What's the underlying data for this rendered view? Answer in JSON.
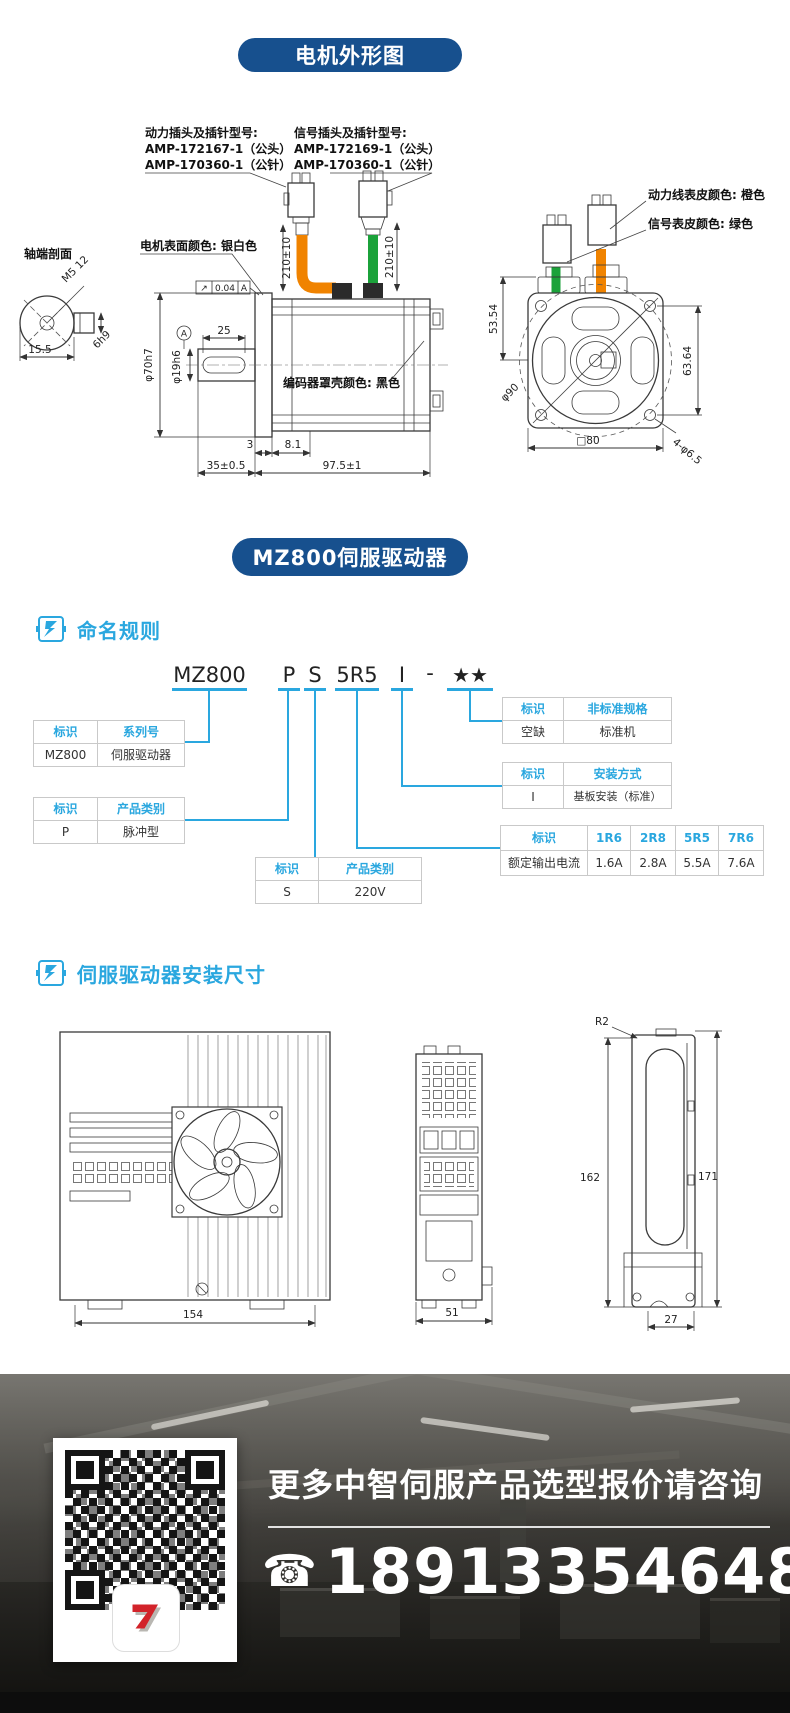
{
  "badges": {
    "motor": "电机外形图",
    "driver": "MZ800伺服驱动器"
  },
  "colors": {
    "accent": "#2AA7DF",
    "badge_bg": "#17508E",
    "power_cable": "#F08300",
    "signal_cable": "#1BA23A"
  },
  "motor": {
    "labels": {
      "power_plug": [
        "动力插头及插针型号:",
        "AMP-172167-1（公头）",
        "AMP-170360-1（公针）"
      ],
      "signal_plug": [
        "信号插头及插针型号:",
        "AMP-172169-1（公头）",
        "AMP-170360-1（公针）"
      ],
      "surface_color": "电机表面颜色: 银白色",
      "encoder_color": "编码器罩壳颜色: 黑色",
      "power_sheath": "动力线表皮颜色: 橙色",
      "signal_sheath": "信号表皮颜色: 绿色",
      "shaft_section": "轴端剖面"
    },
    "dims": {
      "cable_len": "210±10",
      "runout_symbol": "↗",
      "runout_value": "0.04",
      "datum": "A",
      "key_len": "25",
      "shaft_dia": "φ19h6",
      "pilot_dia": "φ70h7",
      "gap": "3",
      "d81": "8.1",
      "len_front": "35±0.5",
      "len_total": "97.5±1",
      "thread": "M5 12",
      "d155": "15.5",
      "key": "6h9",
      "flange_top": "53.54",
      "hole_pitch": "63.64",
      "bolt_circle": "φ90",
      "holes": "4-φ6.5",
      "square": "□80"
    }
  },
  "naming": {
    "title": "命名规则",
    "model_parts": [
      "MZ800",
      "P",
      "S",
      "5R5",
      "I",
      "-",
      "★★"
    ],
    "tables": [
      {
        "headers": [
          "标识",
          "系列号"
        ],
        "row": [
          "MZ800",
          "伺服驱动器"
        ]
      },
      {
        "headers": [
          "标识",
          "产品类别"
        ],
        "row": [
          "P",
          "脉冲型"
        ]
      },
      {
        "headers": [
          "标识",
          "产品类别"
        ],
        "row": [
          "S",
          "220V"
        ]
      },
      {
        "headers": [
          "标识",
          "非标准规格"
        ],
        "row": [
          "空缺",
          "标准机"
        ]
      },
      {
        "headers": [
          "标识",
          "安装方式"
        ],
        "row": [
          "I",
          "基板安装（标准）"
        ]
      },
      {
        "headers": [
          "标识",
          "1R6",
          "2R8",
          "5R5",
          "7R6"
        ],
        "row": [
          "额定输出电流",
          "1.6A",
          "2.8A",
          "5.5A",
          "7.6A"
        ]
      }
    ]
  },
  "install": {
    "title": "伺服驱动器安装尺寸",
    "dims": {
      "width": "154",
      "depth": "51",
      "foot": "27",
      "h_inner": "162",
      "h_outer": "171",
      "radius": "R2"
    }
  },
  "contact": {
    "headline": "更多中智伺服产品选型报价请咨询",
    "phone": "18913354648",
    "phone_icon": "☎"
  }
}
